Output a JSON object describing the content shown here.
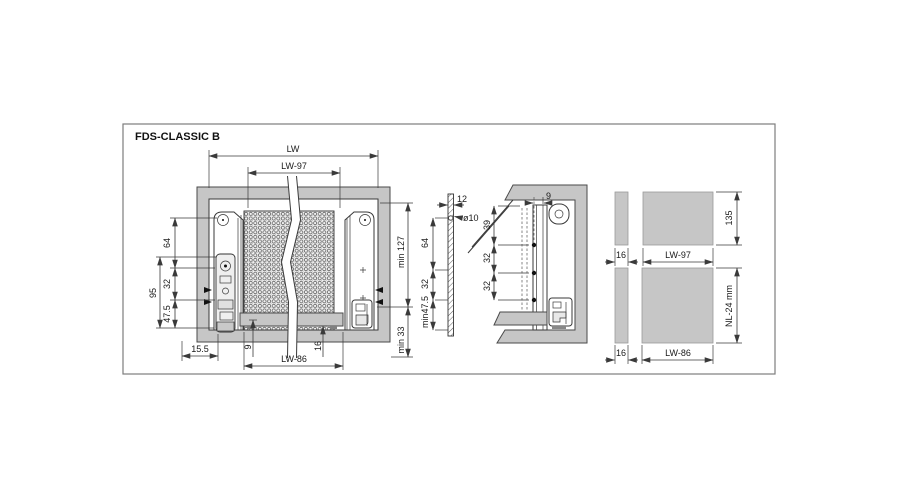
{
  "title": "FDS-CLASSIC B",
  "colors": {
    "cabinet_gray": "#c6c6c6",
    "line": "#3a3a3a",
    "background": "#ffffff"
  },
  "front_view": {
    "dim_lw": "LW",
    "dim_lw_minus_97": "LW-97",
    "dim_64": "64",
    "dim_32": "32",
    "dim_95": "95",
    "dim_47_5": "47.5",
    "dim_15_5": "15.5",
    "dim_9": "9",
    "dim_16": "16",
    "dim_lw_minus_86": "LW-86",
    "dim_min_127": "min 127",
    "dim_min_33": "min 33"
  },
  "back_panel_view": {
    "dim_12": "12",
    "dim_hole_dia": "ø10",
    "dim_64": "64",
    "dim_32": "32",
    "dim_min_47_5": "min47.5"
  },
  "side_view": {
    "dim_9": "9",
    "dim_39": "39",
    "dim_32_upper": "32",
    "dim_32_lower": "32"
  },
  "panels_view": {
    "top": {
      "dim_16": "16",
      "dim_width": "LW-97",
      "dim_height": "135"
    },
    "bottom": {
      "dim_16": "16",
      "dim_width": "LW-86",
      "dim_depth": "NL-24 mm"
    }
  }
}
